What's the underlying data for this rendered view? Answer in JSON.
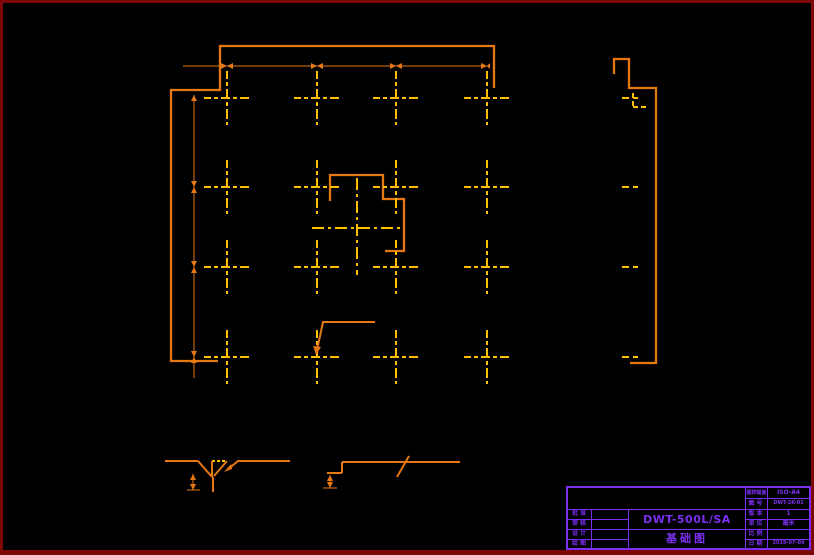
{
  "drawing": {
    "type": "foundation-plan",
    "anchor_bolt_columns_x": [
      227,
      317,
      396,
      487
    ],
    "anchor_bolt_rows_y": [
      98,
      187,
      267,
      357
    ],
    "colors": {
      "outline": "#E67814",
      "centerline": "#FFBE00",
      "dimension": "#E67814",
      "title_block": "#7B2FF2",
      "frame_border": "#7E0707",
      "background": "#000000"
    }
  },
  "title_block": {
    "product_model": "DWT-500L/SA",
    "drawing_name": "基础图",
    "left_rows": [
      {
        "label": "批准"
      },
      {
        "label": "审核"
      },
      {
        "label": "设计"
      },
      {
        "label": "绘图"
      }
    ],
    "right_rows": [
      {
        "label": "图样幅面",
        "value": "ISO-A4"
      },
      {
        "label": "图号",
        "value": "DWT-2K-01"
      },
      {
        "label": "版本",
        "value": "1"
      },
      {
        "label": "单位",
        "value": "毫米"
      },
      {
        "label": "比例",
        "value": ""
      },
      {
        "label": "日期",
        "value": "2019-07-09"
      }
    ]
  }
}
